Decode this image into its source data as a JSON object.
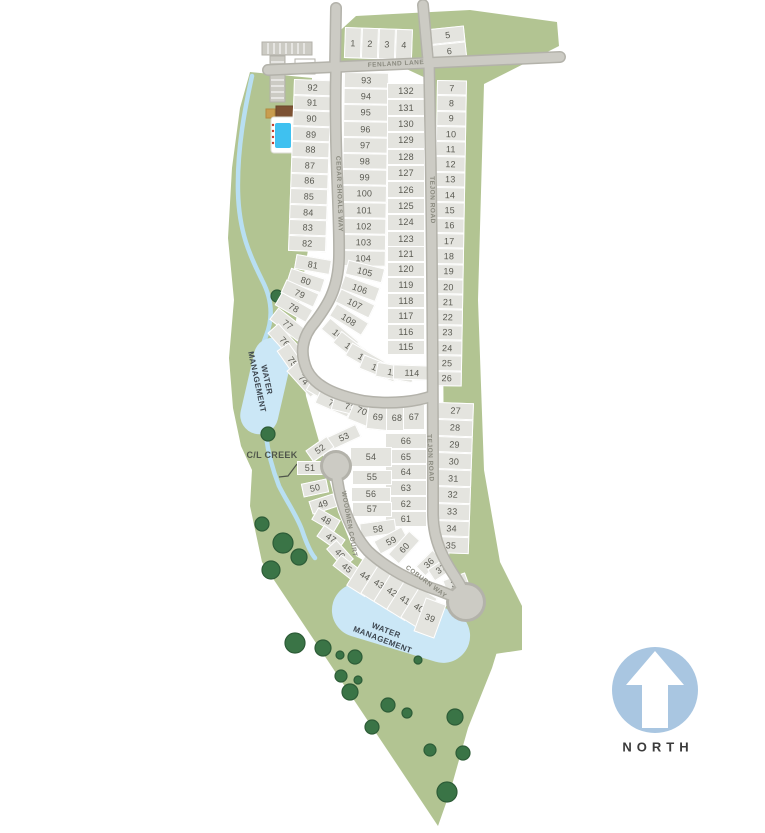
{
  "scene": {
    "streets": {
      "fenland": "FENLAND LANE",
      "cedar_shoals": "CEDAR SHOALS WAY",
      "tejon_upper": "TEJON ROAD",
      "tejon_lower": "TEJON ROAD",
      "woodmen": "WOODMEN COURT",
      "coburn": "COBURN WAY"
    },
    "areas": {
      "water_upper_line1": "WATER",
      "water_upper_line2": "MANAGEMENT",
      "water_lower_line1": "WATER",
      "water_lower_line2": "MANAGEMENT",
      "creek": "C/L CREEK"
    },
    "compass": {
      "label": "NORTH"
    },
    "colors": {
      "land": "#b2c492",
      "parcel": "#e4e4df",
      "road": "#cccbc4",
      "road_edge": "#b3b2aa",
      "water": "#cbe7f6",
      "tree": "#3a7446",
      "pool": "#3fc1f0",
      "north_circle": "#a9c6e1",
      "lot_text": "#5a5a52"
    },
    "lot_groups": [
      {
        "id": "row-1-4",
        "type": "stack",
        "dir": "h",
        "x": 345,
        "y": 27,
        "rot": 2,
        "w": 17,
        "h": 31,
        "lots": [
          1,
          2,
          3,
          4
        ]
      },
      {
        "id": "block-5-6",
        "type": "stack",
        "dir": "v",
        "x": 430,
        "y": 29,
        "rot": -6,
        "w": 34,
        "h": 16,
        "lots": [
          5,
          6
        ]
      },
      {
        "id": "col-92-82",
        "type": "stack",
        "dir": "v",
        "x": 294,
        "y": 79,
        "rot": 2,
        "w": 38,
        "h": 15.6,
        "lots": [
          92,
          91,
          90,
          89,
          88,
          87,
          86,
          85,
          84,
          83,
          82
        ]
      },
      {
        "id": "col-93-104",
        "type": "stack",
        "dir": "v",
        "x": 344,
        "y": 72,
        "rot": 1,
        "w": 45,
        "h": 16.2,
        "lots": [
          93,
          94,
          95,
          96,
          97,
          98,
          99,
          100,
          101,
          102,
          103,
          104
        ]
      },
      {
        "id": "col-132-122",
        "type": "stack",
        "dir": "v",
        "x": 387,
        "y": 83,
        "rot": 0,
        "w": 38,
        "h": 16.4,
        "lots": [
          132,
          131,
          130,
          129,
          128,
          127,
          126,
          125,
          124,
          123,
          122
        ]
      },
      {
        "id": "col-121-115",
        "type": "stack",
        "dir": "v",
        "x": 387,
        "y": 246,
        "rot": 0,
        "w": 38,
        "h": 15.6,
        "lots": [
          121,
          120,
          119,
          118,
          117,
          116,
          115
        ]
      },
      {
        "id": "col-7-26",
        "type": "stack",
        "dir": "v",
        "x": 437,
        "y": 80,
        "rot": 1,
        "w": 30,
        "h": 15.3,
        "lots": [
          7,
          8,
          9,
          10,
          11,
          12,
          13,
          14,
          15,
          16,
          17,
          18,
          19,
          20,
          21,
          22,
          23,
          24,
          25,
          26
        ]
      },
      {
        "id": "col-27-35",
        "type": "stack",
        "dir": "v",
        "x": 438,
        "y": 402,
        "rot": 2,
        "w": 36,
        "h": 16.8,
        "lots": [
          27,
          28,
          29,
          30,
          31,
          32,
          33,
          34,
          35
        ]
      },
      {
        "id": "col-66-61",
        "type": "stack",
        "dir": "v",
        "x": 385,
        "y": 433,
        "rot": 0,
        "w": 42,
        "h": 15.7,
        "lots": [
          66,
          65,
          64,
          63,
          62,
          61
        ]
      },
      {
        "id": "fan-81-71",
        "type": "free",
        "w": 36,
        "h": 15,
        "lots": [
          {
            "n": 81,
            "x": 313,
            "y": 264,
            "r": 10
          },
          {
            "n": 80,
            "x": 306,
            "y": 280,
            "r": 18
          },
          {
            "n": 79,
            "x": 300,
            "y": 293,
            "r": 24
          },
          {
            "n": 78,
            "x": 294,
            "y": 307,
            "r": 30
          },
          {
            "n": 77,
            "x": 288,
            "y": 324,
            "r": 38
          },
          {
            "n": 76,
            "x": 285,
            "y": 341,
            "r": 48
          },
          {
            "n": 75,
            "x": 293,
            "y": 361,
            "r": 55
          },
          {
            "n": 74,
            "x": 304,
            "y": 379,
            "r": 48
          },
          {
            "n": 73,
            "x": 325,
            "y": 392,
            "r": 30
          },
          {
            "n": 72,
            "x": 334,
            "y": 403,
            "r": 24
          },
          {
            "n": 71,
            "x": 350,
            "y": 406,
            "r": 14
          }
        ]
      },
      {
        "id": "fan-105-114",
        "type": "free",
        "w": 38,
        "h": 15,
        "lots": [
          {
            "n": 105,
            "x": 365,
            "y": 271,
            "r": 14
          },
          {
            "n": 106,
            "x": 360,
            "y": 288,
            "r": 20
          },
          {
            "n": 107,
            "x": 355,
            "y": 303,
            "r": 26
          },
          {
            "n": 108,
            "x": 349,
            "y": 319,
            "r": 32
          },
          {
            "n": 109,
            "x": 340,
            "y": 335,
            "r": 40
          },
          {
            "n": 110,
            "x": 352,
            "y": 348,
            "r": 38
          },
          {
            "n": 111,
            "x": 365,
            "y": 358,
            "r": 30
          },
          {
            "n": 112,
            "x": 379,
            "y": 368,
            "r": 22
          },
          {
            "n": 113,
            "x": 395,
            "y": 372,
            "r": 10
          },
          {
            "n": 114,
            "x": 412,
            "y": 372,
            "r": 2
          }
        ]
      },
      {
        "id": "row-67-70",
        "type": "free",
        "w": 22,
        "h": 26,
        "lots": [
          {
            "n": 70,
            "x": 362,
            "y": 411,
            "r": 22
          },
          {
            "n": 69,
            "x": 378,
            "y": 417,
            "r": 6
          },
          {
            "n": 68,
            "x": 397,
            "y": 418,
            "r": 0
          },
          {
            "n": 67,
            "x": 414,
            "y": 417,
            "r": 0
          }
        ]
      },
      {
        "id": "col-54-58",
        "type": "free",
        "w": 40,
        "h": 15,
        "lots": [
          {
            "n": 54,
            "x": 371,
            "y": 457,
            "r": 0,
            "w": 42,
            "h": 20
          },
          {
            "n": 55,
            "x": 372,
            "y": 477,
            "r": 0
          },
          {
            "n": 56,
            "x": 371,
            "y": 494,
            "r": 0
          },
          {
            "n": 57,
            "x": 372,
            "y": 509,
            "r": 0
          },
          {
            "n": 58,
            "x": 378,
            "y": 528,
            "r": -8,
            "w": 36
          }
        ]
      },
      {
        "id": "fan-59-60",
        "type": "free",
        "w": 32,
        "h": 15,
        "lots": [
          {
            "n": 59,
            "x": 391,
            "y": 540,
            "r": -28
          },
          {
            "n": 60,
            "x": 404,
            "y": 547,
            "r": -48
          }
        ]
      },
      {
        "id": "fan-45-53",
        "type": "free",
        "w": 26,
        "h": 14,
        "lots": [
          {
            "n": 53,
            "x": 344,
            "y": 437,
            "r": -25,
            "w": 32
          },
          {
            "n": 52,
            "x": 320,
            "y": 449,
            "r": -35
          },
          {
            "n": 51,
            "x": 310,
            "y": 468,
            "r": 0
          },
          {
            "n": 50,
            "x": 315,
            "y": 488,
            "r": -12
          },
          {
            "n": 49,
            "x": 323,
            "y": 504,
            "r": -18
          },
          {
            "n": 48,
            "x": 326,
            "y": 520,
            "r": 30
          },
          {
            "n": 47,
            "x": 331,
            "y": 538,
            "r": 35
          },
          {
            "n": 46,
            "x": 340,
            "y": 554,
            "r": 48
          },
          {
            "n": 45,
            "x": 347,
            "y": 568,
            "r": 38
          }
        ]
      },
      {
        "id": "row-44-39",
        "type": "free",
        "w": 22,
        "h": 36,
        "lots": [
          {
            "n": 44,
            "x": 365,
            "y": 576,
            "r": 32
          },
          {
            "n": 43,
            "x": 379,
            "y": 584,
            "r": 32
          },
          {
            "n": 42,
            "x": 392,
            "y": 592,
            "r": 32
          },
          {
            "n": 41,
            "x": 405,
            "y": 600,
            "r": 32
          },
          {
            "n": 40,
            "x": 419,
            "y": 608,
            "r": 32
          },
          {
            "n": 39,
            "x": 430,
            "y": 618,
            "r": 20
          }
        ]
      },
      {
        "id": "fan-36-38",
        "type": "free",
        "w": 24,
        "h": 14,
        "lots": [
          {
            "n": 36,
            "x": 429,
            "y": 563,
            "r": -45
          },
          {
            "n": 37,
            "x": 441,
            "y": 569,
            "r": -33
          },
          {
            "n": 38,
            "x": 456,
            "y": 583,
            "r": -20
          }
        ]
      }
    ]
  }
}
